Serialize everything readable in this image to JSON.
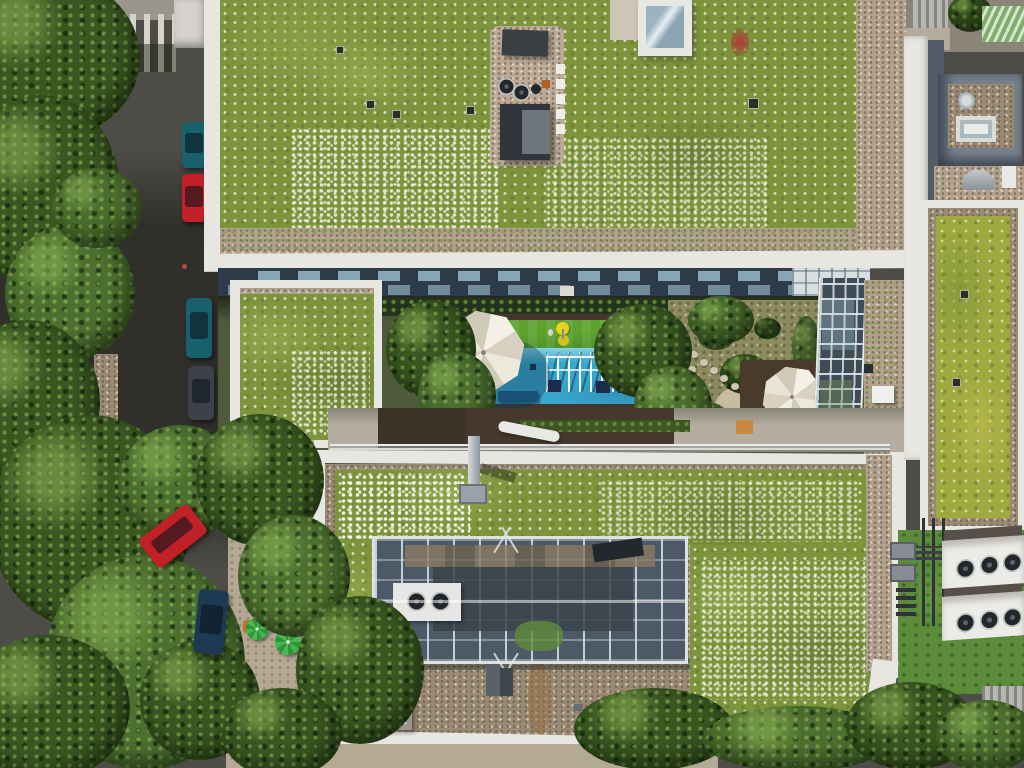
{
  "scene": {
    "title": "aerial-view-green-roof-courtyard",
    "description": "Top-down drone photo: two apartment blocks with wildflower green roofs, a shared courtyard with a playground (artificial turf and blue safety surface, white climbing frame, two white patio umbrellas), a glazed steel atrium skylight on the lower roof, rooftop HVAC fan units, a side street with parked cars, a cafe terrace with green umbrellas and dense tree canopies.",
    "palette": {
      "asphalt": "#4e4c47",
      "sidewalk": "#9a968c",
      "tree_dark": "#3a5722",
      "tree_light": "#4d7030",
      "roof_green": "#7e943c",
      "roof_yellow_green": "#9fa93f",
      "gravel": "#b2a18c",
      "parapet_white": "#e8e6e0",
      "facade_dark": "#2d3c48",
      "window_glass": "#8fb0c2",
      "turf_green": "#5ca32e",
      "pool_blue": "#39a7cd",
      "deck_brown": "#44362b",
      "umbrella_white": "#e9e5d7",
      "umbrella_cafe_green": "#3fae4a",
      "car_red": "#c22027",
      "car_teal": "#17606c",
      "car_gray": "#3c4247",
      "car_blue": "#1d3a55",
      "atrium_steel": "#4d5966",
      "hvac_white": "#ebebe7",
      "fan_dark": "#2b3136",
      "lawn_grass": "#5c8c3a",
      "penthouse_wall": "#77828f",
      "play_yellow": "#e5d31f",
      "crate_orange": "#c9893f",
      "bench_blue": "#1e5f8a"
    },
    "objects": [
      "street-crosswalk",
      "parked-cars",
      "cafe-terrace-umbrellas",
      "tree-canopy",
      "top-green-roof",
      "rooftop-equipment",
      "roof-skylight",
      "building-facade-windows",
      "courtyard-garden",
      "playground-turf",
      "playground-blue-surface",
      "climbing-frame",
      "patio-umbrella",
      "garden-deck",
      "glass-atrium-wall",
      "side-green-roof",
      "lower-green-roof",
      "atrium-skylight-structure",
      "chimney-vent",
      "hvac-fan-units",
      "penthouse-roof-structure",
      "stepping-stones"
    ]
  }
}
